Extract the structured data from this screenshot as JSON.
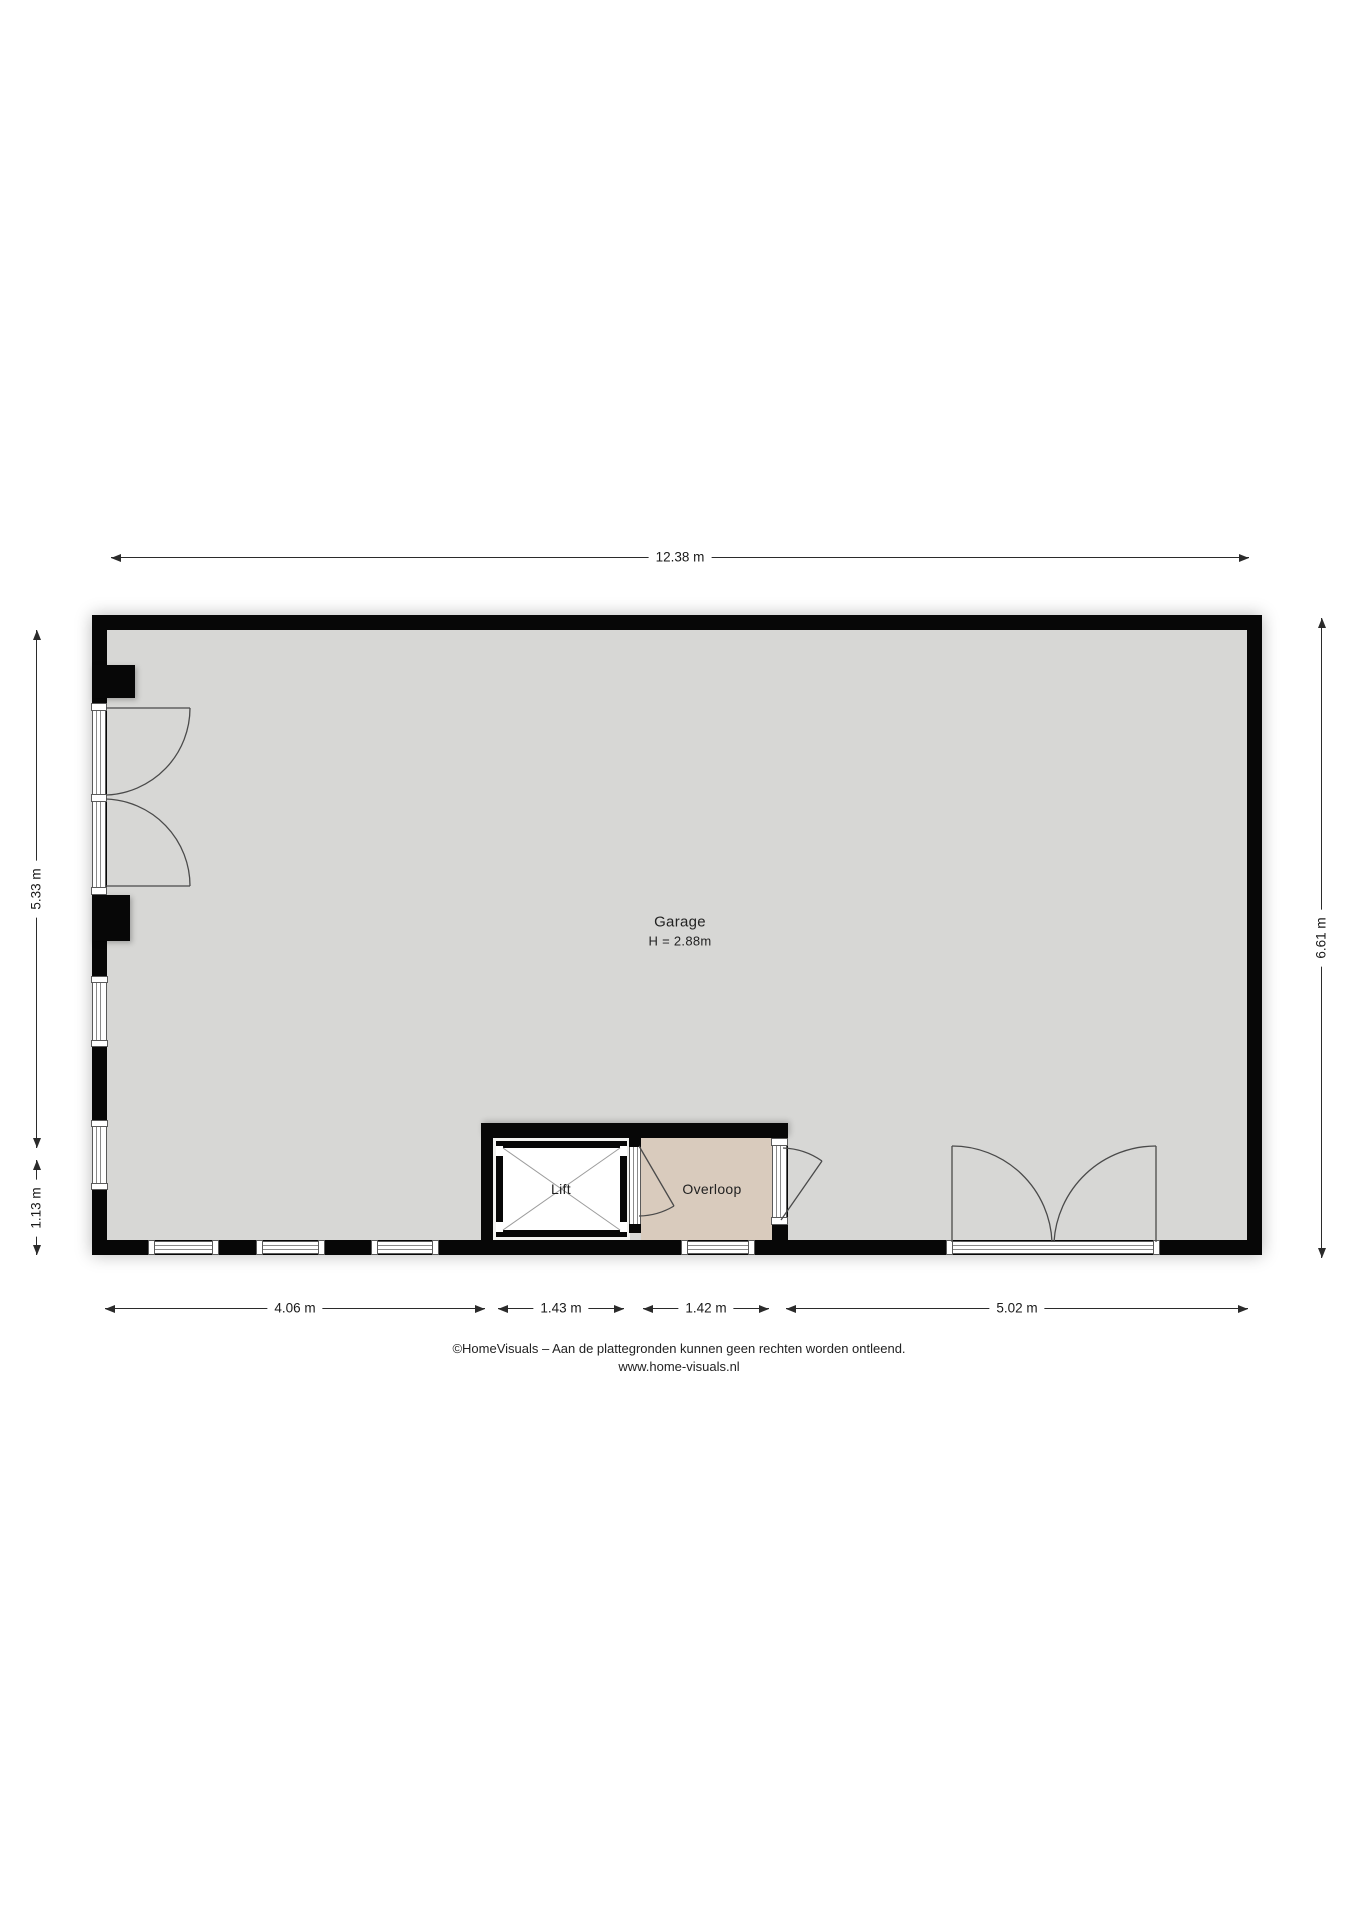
{
  "rooms": {
    "garage": {
      "label": "Garage",
      "height_label": "H = 2.88m"
    },
    "lift": {
      "label": "Lift"
    },
    "overloop": {
      "label": "Overloop"
    }
  },
  "dimensions": {
    "top": "12.38 m",
    "left_upper": "5.33 m",
    "left_lower": "1.13 m",
    "right": "6.61 m",
    "bottom": [
      "4.06 m",
      "1.43 m",
      "1.42 m",
      "5.02 m"
    ]
  },
  "footer": {
    "line1": "©HomeVisuals – Aan de plattegronden kunnen geen rechten worden ontleend.",
    "line2": "www.home-visuals.nl"
  },
  "colors": {
    "wall": "#070707",
    "floor_garage": "#d7d7d5",
    "floor_overloop": "#d9cbbd",
    "floor_lift": "#ffffff",
    "dimension_line": "#2b2b2b"
  }
}
